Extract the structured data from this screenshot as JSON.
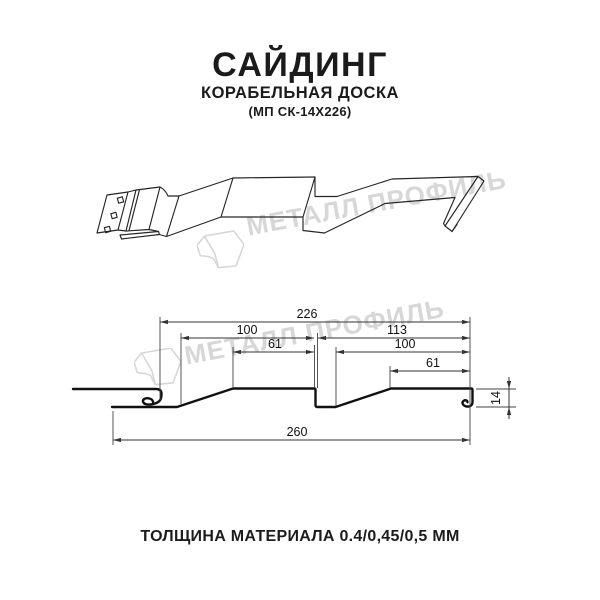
{
  "header": {
    "title": "САЙДИНГ",
    "subtitle": "КОРАБЕЛЬНАЯ ДОСКА",
    "product_code": "(МП СК-14Х226)"
  },
  "watermark": {
    "brand": "МЕТАЛЛ ПРОФИЛЬ",
    "color": "#d7d7d7"
  },
  "section_drawing": {
    "dimensions_mm": {
      "top_module_total": "226",
      "left_module": "100",
      "right_module": "113",
      "left_flat": "61",
      "right_module_inner": "100",
      "right_flat": "61",
      "profile_height": "14",
      "overall_width": "260"
    }
  },
  "footer": {
    "material_thickness": "ТОЛЩИНА МАТЕРИАЛА 0.4/0,45/0,5 ММ"
  },
  "colors": {
    "background": "#ffffff",
    "line": "#1f1f1f"
  }
}
